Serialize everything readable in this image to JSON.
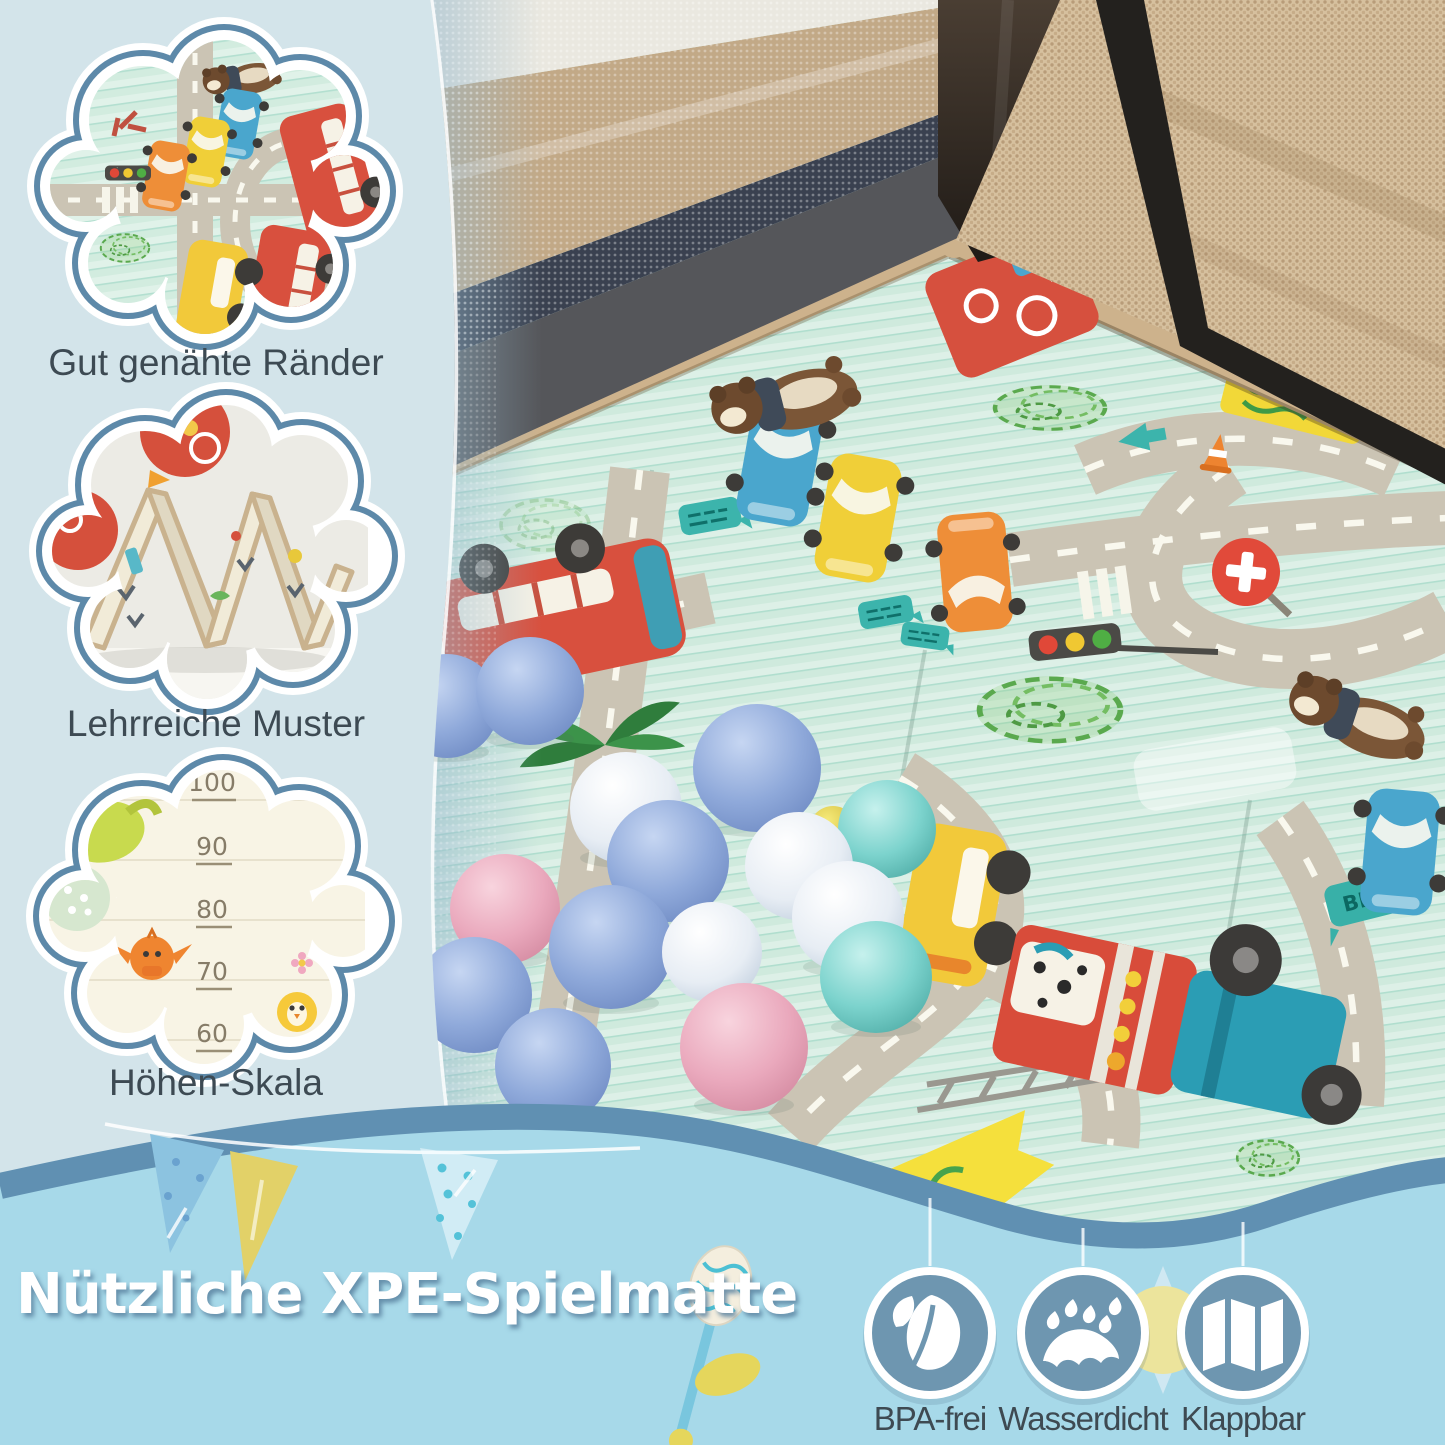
{
  "page": {
    "type": "product-infographic",
    "language": "de"
  },
  "badges": [
    {
      "caption": "Gut genähte Ränder"
    },
    {
      "caption": "Lehrreiche Muster"
    },
    {
      "caption": "Höhen-Skala",
      "scale_values": [
        "100",
        "90",
        "80",
        "70",
        "60"
      ]
    }
  ],
  "photo": {
    "truck_text": "TRUCK",
    "beep_text": "BEEP"
  },
  "banner": {
    "title": "Nützliche XPE-Spielmatte"
  },
  "features": [
    {
      "label": "BPA-frei",
      "icon": "leaf-icon"
    },
    {
      "label": "Wasserdicht",
      "icon": "raindrops-icon"
    },
    {
      "label": "Klappbar",
      "icon": "folded-mat-icon"
    }
  ],
  "colors": {
    "background_left": "#d3e4ea",
    "band": "#a7d9e9",
    "accent_blue": "#6090b2",
    "cloud_border": "#5d89a9",
    "icon_circle": "#6e96b0",
    "caption_text": "#3d4a53",
    "title_text": "#ffffff",
    "mat_mint": "#cfeadd",
    "mat_border_tan": "#cdb28c",
    "ball_blue": "#8ea7d8",
    "ball_pink": "#e8a8bc",
    "ball_white": "#e6ebf1",
    "ball_teal": "#7ad0cb"
  }
}
